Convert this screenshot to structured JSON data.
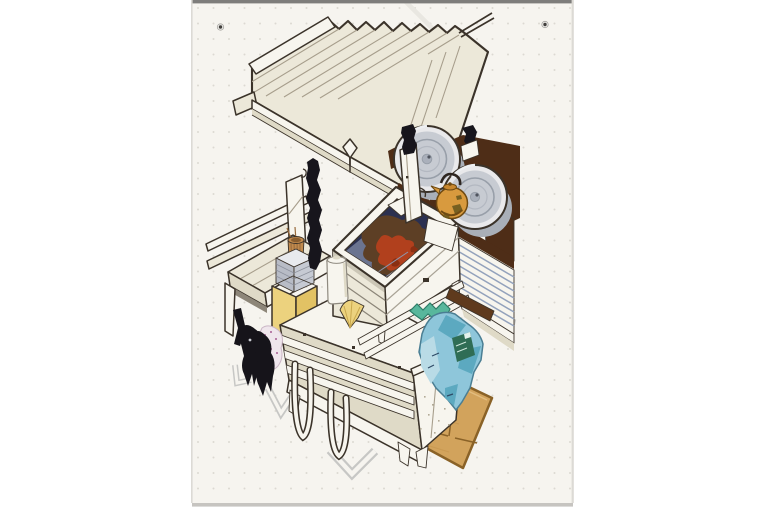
{
  "meta": {
    "description": "Scanned marker-and-ink isometric concept sketch of a charcoal-grill street food cart, drawn on a dot-grid sketchbook page with two punch holes at the top",
    "page_type": "dot-grid sketchbook sheet",
    "punch_holes": 2
  },
  "colors": {
    "background": "#ffffff",
    "paper": "#f6f4ef",
    "paper_edge_top": "#7e7d7b",
    "paper_edge_shadow": "#c6c4c0",
    "paper_edge_side": "#dcdad5",
    "dot_grid": "#dcd9d2",
    "crease": "#e9e7e1",
    "hole_ring": "#efeeea",
    "hole_dark": "#413f3c",
    "ink": "#3b332a",
    "cream": "#ece8d9",
    "cream_shade": "#dfdac7",
    "white_wood": "#f7f5ee",
    "slat_shadow": "#8d8679",
    "shade_band": "#cbc6b6",
    "seam": "#a79e8c",
    "dark_brown": "#4e2d17",
    "red_brown": "#5f3a1d",
    "keg_rim": "#e9e9eb",
    "keg_silver": "#c7cbd2",
    "keg_shade": "#a9afb8",
    "keg_ring": "#989fa9",
    "keg_ring2": "#b3b8c1",
    "keg_cap": "#aab0bb",
    "keg_dot": "#4f545e",
    "keg_hi": "#eef0f2",
    "grill_navy": "#2b3050",
    "grill_wall": "#6b7490",
    "coal_brown": "#5d3f25",
    "coal_red": "#b1401d",
    "coal_red_dark": "#8a2f12",
    "grate": "#8e94ab",
    "kettle_amber": "#d89a3e",
    "kettle_dark": "#6f4a12",
    "kettle_lid": "#c8872e",
    "kettle_blotch": "#6d5a1e",
    "handle_dark": "#2e2620",
    "basket_tan": "#c08a4e",
    "basket_line": "#97693a",
    "basket_inner": "#8a5e2f",
    "box_yellow": "#ecd27e",
    "box_yellow_side": "#e2c264",
    "napkin_top": "#e8eaee",
    "napkin_gray": "#b8bcc6",
    "napkin_side": "#c6cad3",
    "napkin_line": "#8f939e",
    "glove_black": "#16141a",
    "glove_hi": "#caccd2",
    "cloth_pink": "#efe6ec",
    "cloth_dot": "#b87fa8",
    "stripe_blue": "#93a2bc",
    "bag_blue": "#8ec6da",
    "bag_outline": "#4a7e93",
    "bag_mid": "#5ca9c0",
    "bag_pale": "#b9dbe6",
    "bag_green": "#2f6d55",
    "bag_tag": "#e4f1ec",
    "bag_scribble": "#cfe7dd",
    "bag_mark": "#2e4a66",
    "zigzag_teal": "#58b79c",
    "zigzag_edge": "#2e7d68",
    "board_wood": "#d2a35c",
    "board_edge": "#8a6227",
    "board_grain": "#c6964e",
    "board_light": "#e2bc7e",
    "marker_gray": "#c7c7c5",
    "pole_black": "#17151c",
    "bottle_line": "#8f8a80",
    "speckle": "#b2ab97",
    "fan_fold": "#c9a84e"
  },
  "scene": {
    "objects": [
      {
        "name": "plank-canopy",
        "desc": "slanted cream plank roof with jagged board ends"
      },
      {
        "name": "twisted-black-pole",
        "desc": "knobby black support pole under roof"
      },
      {
        "name": "metal-keg-left",
        "desc": "silver keg seen from its round lid"
      },
      {
        "name": "metal-keg-right",
        "desc": "second silver keg on dark counter"
      },
      {
        "name": "copper-kettle",
        "desc": "amber speckled kettle between kegs"
      },
      {
        "name": "charcoal-grill",
        "desc": "open firebox with navy pit and glowing red coals"
      },
      {
        "name": "skewer-basket",
        "desc": "tan cylindrical stick holder"
      },
      {
        "name": "napkin-stack",
        "desc": "gray stack of sheets in a carton"
      },
      {
        "name": "yellow-carton",
        "desc": "yellow open box on shelf"
      },
      {
        "name": "squeeze-bottle",
        "desc": "white bottle beside grill"
      },
      {
        "name": "black-gloves",
        "desc": "pair of black mitts hanging on left side"
      },
      {
        "name": "polka-dot-cloth",
        "desc": "pink dotted rag behind the gloves"
      },
      {
        "name": "slatted-cart-body",
        "desc": "cream cabinet with slat shelves and legs"
      },
      {
        "name": "tube-handles",
        "desc": "two U-shaped tube handles on front"
      },
      {
        "name": "striped-side-panel",
        "desc": "blue-gray striped louver panel on right"
      },
      {
        "name": "blue-plastic-bag",
        "desc": "crumpled blue bag with green label"
      },
      {
        "name": "teal-wrapper",
        "desc": "small teal crumpled wrapper on shelf edge"
      },
      {
        "name": "wooden-floor-board",
        "desc": "tan plywood board on the ground"
      },
      {
        "name": "floor-corner-marks",
        "desc": "light gray footprint corner brackets"
      },
      {
        "name": "folded-napkin-fan",
        "desc": "small fan-folded yellow napkin"
      }
    ]
  }
}
